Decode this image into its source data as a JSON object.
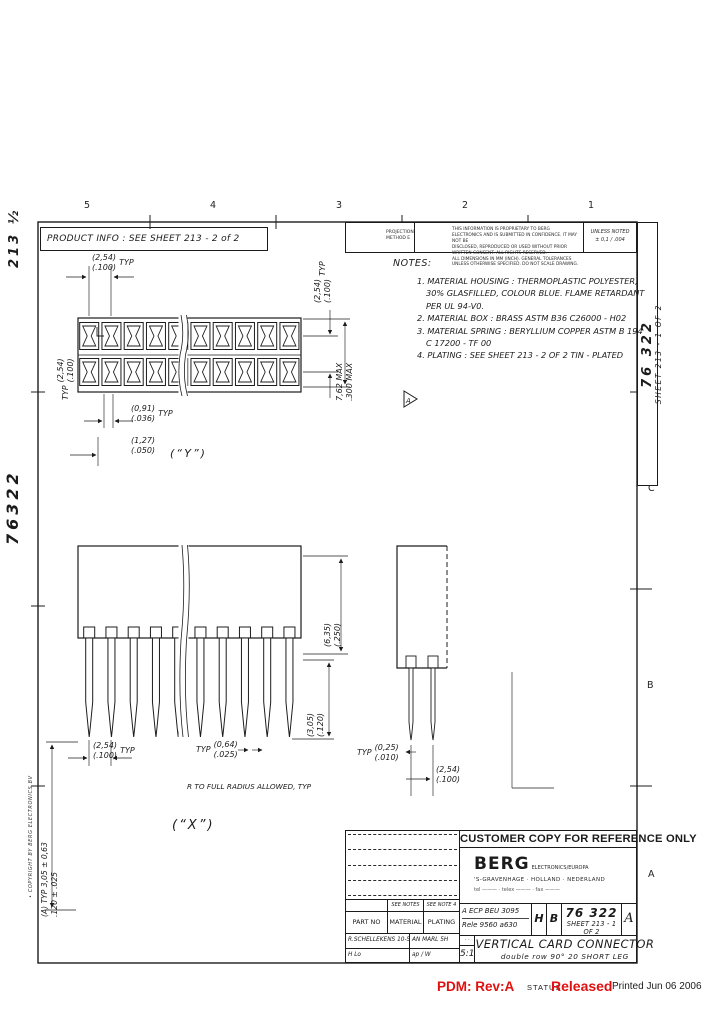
{
  "ink": "#1b1b1b",
  "red": "#e01010",
  "margin": {
    "sheet_note": "213 ½",
    "part_scrawl": "76322",
    "copyright": "• COPYRIGHT BY BERG ELECTRONICS BV"
  },
  "zones": {
    "top": [
      "5",
      "4",
      "3",
      "2",
      "1"
    ],
    "right": [
      "D",
      "C",
      "B",
      "A"
    ]
  },
  "edge_box": {
    "part": "76 322",
    "sheet": "SHEET 213 - 1 OF 2"
  },
  "header": {
    "product_note": "PRODUCT INFO : SEE SHEET 213 - 2 of 2",
    "projection": [
      "PROJECTION",
      "METHOD E"
    ],
    "disclaimer": [
      "THIS INFORMATION IS PROPRIETARY TO BERG ELECTRONICS AND IS SUBMITTED IN CONFIDENCE. IT MAY NOT BE",
      "DISCLOSED, REPRODUCED OR USED WITHOUT PRIOR WRITTEN CONSENT. ALL RIGHTS RESERVED.",
      "ALL DIMENSIONS IN MM (INCH). GENERAL TOLERANCES UNLESS OTHERWISE SPECIFIED. DO NOT SCALE DRAWING."
    ],
    "tolerance_box": [
      "UNLESS NOTED",
      "± 0,1 / .004"
    ]
  },
  "notes": {
    "title": "NOTES:",
    "items": [
      [
        "1. MATERIAL HOUSING : THERMOPLASTIC POLYESTER,",
        "30% GLASFILLED, COLOUR BLUE.  FLAME RETARDANT",
        "PER  UL 94-V0."
      ],
      [
        "2. MATERIAL BOX : BRASS  ASTM B36 C26000 - H02"
      ],
      [
        "3. MATERIAL SPRING : BERYLLIUM COPPER ASTM B 194",
        "C 17200 - TF 00"
      ],
      [
        "4. PLATING : SEE SHEET 213 - 2 OF 2   TIN - PLATED"
      ]
    ],
    "rev_flag": "A"
  },
  "views": {
    "top": {
      "columns": 10,
      "rows": 2
    },
    "front": {
      "pins": 10
    },
    "side": {
      "pins": 2
    },
    "label_top": "(“Y”)",
    "label_front": "(“X”)"
  },
  "dims": {
    "pitch_top": {
      "l1": "(2,54)",
      "l2": "(.100)",
      "typ": "TYP"
    },
    "row_pitch_left": {
      "typ": "TYP",
      "l1": "(2,54)",
      "l2": "(.100)"
    },
    "col_pitch_right": {
      "l1": "(2,54)",
      "l2": "(.100)",
      "typ": "TYP"
    },
    "height_max": {
      "l1": "7,62 MAX",
      "l2": ".300 MAX"
    },
    "slot_width": {
      "l1": "(0,91)",
      "l2": "(.036)",
      "typ": "TYP"
    },
    "slot_pitch": {
      "l1": "(1,27)",
      "l2": "(.050)"
    },
    "body_height": {
      "l1": "(6,35)",
      "l2": "(.250)"
    },
    "lead_length": {
      "l1": "(3,05)",
      "l2": "(.120)"
    },
    "tail_a": {
      "l1": "(A)  TYP  3,05 ± 0,63",
      "l2": ".120 ± .025"
    },
    "pitch_bottom": {
      "l1": "(2,54)",
      "l2": "(.100)",
      "typ": "TYP"
    },
    "pin_width": {
      "typ": "TYP",
      "l1": "(0,64)",
      "l2": "(.025)"
    },
    "radius_note": "R TO FULL RADIUS ALLOWED, TYP",
    "tail_thickness": {
      "typ": "TYP",
      "l1": "(0,25)",
      "l2": "(.010)"
    },
    "side_pitch": {
      "l1": "(2,54)",
      "l2": "(.100)"
    }
  },
  "title_block": {
    "banner": "CUSTOMER COPY FOR REFERENCE ONLY",
    "brand": {
      "name": "BERG",
      "tag": "ELECTRONICS/EUROPA",
      "addr": "'S-GRAVENHAGE · HOLLAND · NEDERLAND",
      "addr2": "tel ——— · telex ——— · fax ———"
    },
    "table": {
      "see_notes": "SEE NOTES",
      "see_note4": "SEE NOTE 4",
      "part_no": "PART NO",
      "material": "MATERIAL",
      "plating": "PLATING"
    },
    "revision": {
      "line1": "A ECP BEU 3095",
      "line2": "Rele 9560 a630"
    },
    "size_h": "H",
    "size_b": "B",
    "part_number": "76 322",
    "sheet": "SHEET 213 - 1 OF 2",
    "rev_letter": "A",
    "signatures": {
      "s1": "R.SCHELLEKENS  10-5-93",
      "s2": "AN  MARL  5H",
      "s3": "H Lo",
      "s4": "ap / W"
    },
    "scale_note": "· ·",
    "scale": "5:1",
    "title": "VERTICAL CARD CONNECTOR",
    "subtitle": "double row 90° 20  SHORT LEG"
  },
  "status_bar": {
    "pdm": "PDM: Rev:A",
    "status_label": "STATUS",
    "status_value": "Released",
    "printed": "Printed Jun 06 2006"
  }
}
